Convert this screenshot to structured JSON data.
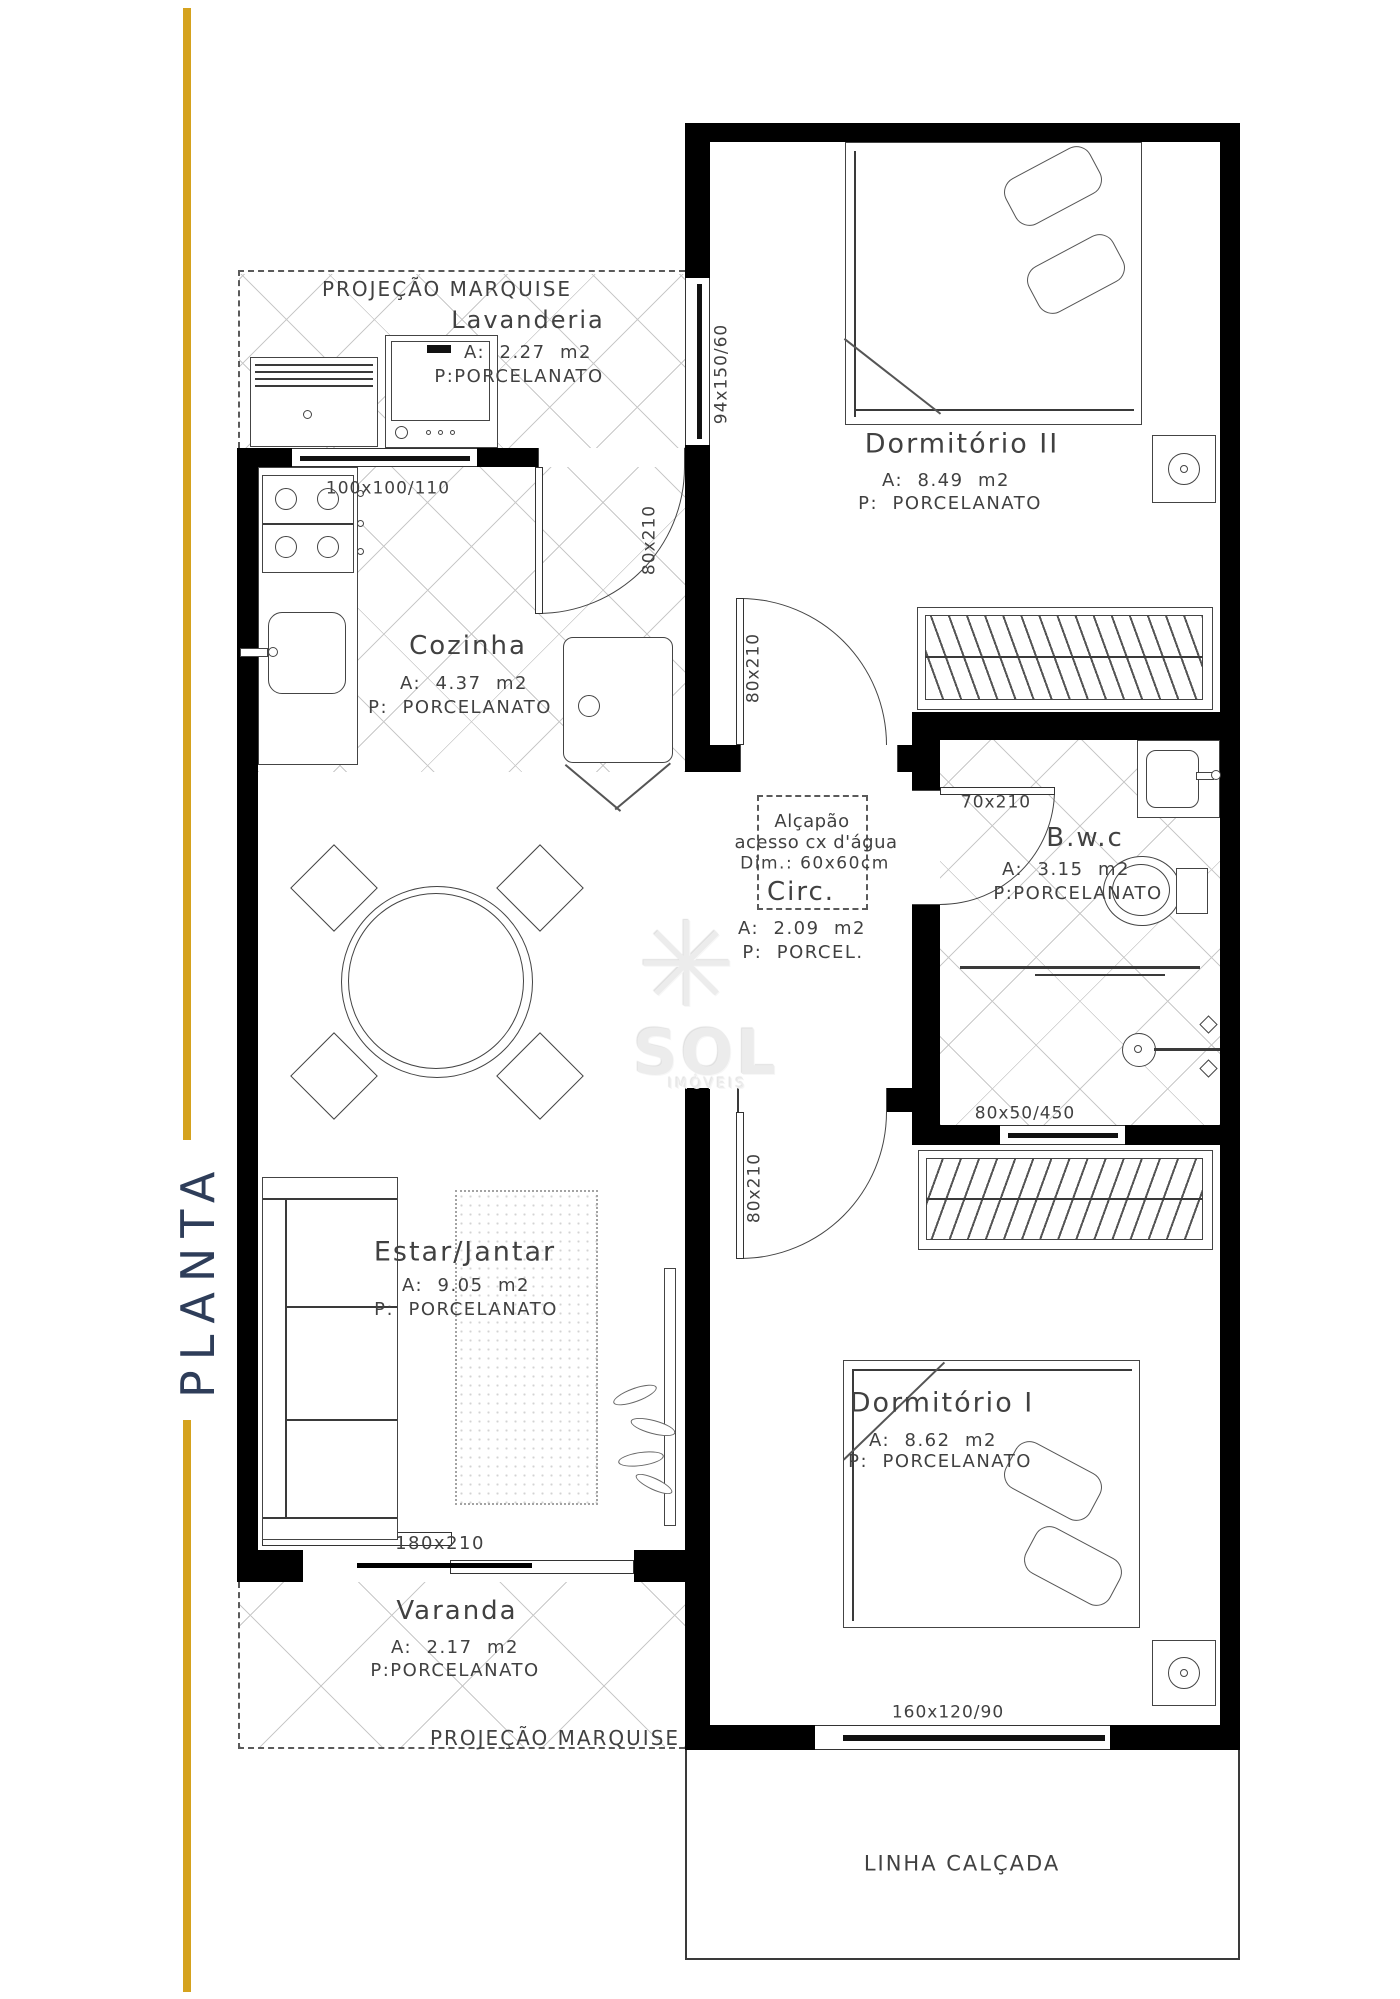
{
  "sidebar": {
    "title": "PLANTA"
  },
  "watermark": {
    "brand": "SOL",
    "brand_sub": "IMÓVEIS",
    "star_icon": "✳"
  },
  "annotations": {
    "marquise_top": "PROJEÇÃO MARQUISE",
    "marquise_bottom": "PROJEÇÃO MARQUISE",
    "sidewalk": "LINHA CALÇADA",
    "hatch_title": "Alçapão",
    "hatch_line2": "acesso cx d'água",
    "hatch_line3": "Dim.: 60x60cm"
  },
  "rooms": {
    "lavanderia": {
      "name": "Lavanderia",
      "area": "A:  2.27  m2",
      "floor": "P:PORCELANATO"
    },
    "cozinha": {
      "name": "Cozinha",
      "area": "A:  4.37  m2",
      "floor": "P:  PORCELANATO"
    },
    "dormitorio2": {
      "name": "Dormitório II",
      "area": "A:  8.49  m2",
      "floor": "P:  PORCELANATO"
    },
    "circulacao": {
      "name": "Circ.",
      "area": "A:  2.09  m2",
      "floor": "P:  PORCEL."
    },
    "bwc": {
      "name": "B.w.c",
      "area": "A:  3.15  m2",
      "floor": "P:PORCELANATO"
    },
    "estar": {
      "name": "Estar/Jantar",
      "area": "A:  9.05  m2",
      "floor": "P:  PORCELANATO"
    },
    "dormitorio1": {
      "name": "Dormitório I",
      "area": "A:  8.62  m2",
      "floor": "P:  PORCELANATO"
    },
    "varanda": {
      "name": "Varanda",
      "area": "A:  2.17  m2",
      "floor": "P:PORCELANATO"
    }
  },
  "dimensions": {
    "lavanderia_window": "94x150/60",
    "kitchen_window": "100x100/110",
    "kitchen_door": "80x210",
    "dorm2_door": "80x210",
    "bwc_door": "70x210",
    "bwc_window": "80x50/450",
    "dorm1_door": "80x210",
    "sliding_door": "180x210",
    "dorm1_window": "160x120/90"
  },
  "colors": {
    "accent_gold": "#D5A21E",
    "plan_line": "#3F3F3F",
    "title_color": "#2E3D59"
  }
}
